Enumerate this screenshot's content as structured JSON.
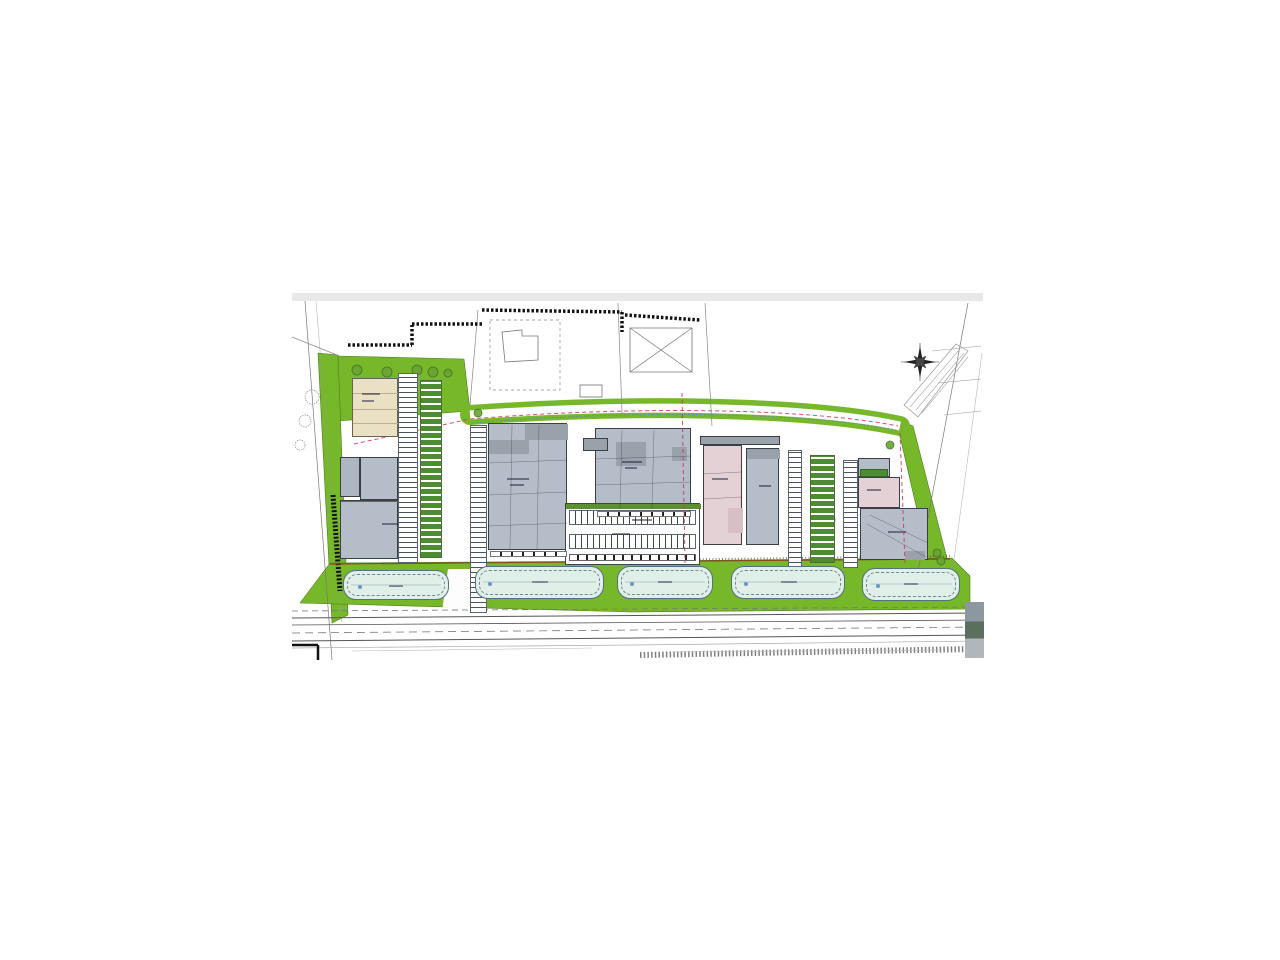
{
  "app": {
    "name": "architectural-site-plan",
    "description": "Scanned architectural site plan of a commercial development with five parking lots along a road, gray warehouse buildings, a beige block, pink blocks, green landscaping and a red location arrow marking one unit"
  },
  "palette": {
    "paper": "#ffffff",
    "topbar": "#e8e8e8",
    "green": "#76b82a",
    "green_edge": "#4e7d1e",
    "green_dark": "#4d8c33",
    "lot_fill": "#e0efe8",
    "lot_edge": "#55707e",
    "gray": "#b5bdc9",
    "gray_dark": "#99a1ab",
    "beige": "#eae1c4",
    "pink": "#e4d1d5",
    "pink_dark": "#d8bfc6",
    "terrace_green": "#5d9032",
    "marker_red": "#e81c1d",
    "red_dash": "#cc3060",
    "blue_dash": "#5b7fd4",
    "brown": "#8a4a20",
    "ink": "#333333"
  },
  "plan": {
    "x": 292,
    "y": 293,
    "w": 691,
    "h": 367,
    "topbar_h": 8
  },
  "band": {
    "d": "M178,122 C350,110 520,114 608,133",
    "green_w": 20,
    "road_w": 9,
    "red_d": "M62,151 L178,126 C350,112 520,116 606,133",
    "blue_d": "M180,130 C350,116 520,120 604,137"
  },
  "greens": [
    {
      "name": "green-topleft",
      "pts": "45,63 172,66 178,118 45,128"
    },
    {
      "name": "green-left-verge",
      "pts": "26,60 46,62 56,322 40,330"
    },
    {
      "name": "green-right-wedge",
      "pts": "604,126 621,133 658,277 640,282"
    },
    {
      "name": "green-bottom-strip",
      "pts": "8,310 38,270 350,268 660,265 678,283 678,316 340,319"
    }
  ],
  "polygons": [
    {
      "name": "access-road",
      "pts": "156,276 184,276 190,318 150,318",
      "f": "#fdfdfd"
    },
    {
      "name": "neighbor-house-outline",
      "pts": "210,39 230,37 230,43 246,43 246,67 213,69",
      "f": "none",
      "s": "#777",
      "w": 0.8
    },
    {
      "name": "neighbor-barn-outline",
      "pts": "338,35 400,35 400,79 338,79",
      "f": "none",
      "s": "#777",
      "w": 0.8
    },
    {
      "name": "parcel-dashed",
      "pts": "198,27 268,27 268,97 198,97",
      "f": "none",
      "s": "#888",
      "w": 0.7,
      "d": "3 3"
    },
    {
      "name": "label-box",
      "pts": "288,92 310,92 310,104 288,104",
      "f": "none",
      "s": "#666",
      "w": 0.7
    },
    {
      "name": "driveway-outline",
      "pts": "612,112 664,51 676,58 626,124",
      "f": "none",
      "s": "#999",
      "w": 0.7
    }
  ],
  "lines": [
    [
      13,
      8,
      40,
      367,
      "#777",
      0.7,
      0,
      0,
      "u"
    ],
    [
      24,
      8,
      50,
      330,
      "#999",
      0.6,
      0,
      0.7,
      "u"
    ],
    [
      0,
      44,
      45,
      62,
      "#888",
      0.7,
      0,
      0,
      "u"
    ],
    [
      186,
      17,
      178,
      112,
      "#888",
      0.7,
      0,
      0,
      "u"
    ],
    [
      326,
      10,
      330,
      120,
      "#888",
      0.7,
      0,
      0,
      "u"
    ],
    [
      413,
      10,
      420,
      133,
      "#888",
      0.7,
      0,
      0,
      "u"
    ],
    [
      676,
      10,
      622,
      300,
      "#777",
      0.7,
      0,
      0,
      "u"
    ],
    [
      690,
      60,
      658,
      296,
      "#999",
      0.6,
      0,
      0.7,
      "u"
    ],
    [
      640,
      58,
      689,
      53,
      "#999",
      0.6,
      0,
      0,
      "u"
    ],
    [
      646,
      90,
      689,
      86,
      "#999",
      0.6,
      0,
      0,
      "u"
    ],
    [
      652,
      122,
      689,
      118,
      "#999",
      0.6,
      0,
      0,
      "u"
    ],
    [
      338,
      35,
      400,
      79,
      "#777",
      0.7,
      0,
      0,
      "u"
    ],
    [
      400,
      35,
      338,
      79,
      "#777",
      0.7,
      0,
      0,
      "u"
    ],
    [
      56,
      52,
      120,
      52,
      "#111",
      3.5,
      "2.5 2",
      0,
      "u"
    ],
    [
      120,
      52,
      120,
      32,
      "#111",
      3.5,
      "2.5 2",
      0,
      "u"
    ],
    [
      120,
      31,
      190,
      31,
      "#111",
      3.5,
      "2.5 2",
      0,
      "u"
    ],
    [
      190,
      17,
      330,
      19,
      "#111",
      3.5,
      "2.5 2",
      0,
      "u"
    ],
    [
      330,
      19,
      330,
      39,
      "#111",
      3.5,
      "2.5 2",
      0,
      "u"
    ],
    [
      333,
      22,
      408,
      27,
      "#111",
      3.5,
      "2.5 2",
      0,
      "u"
    ],
    [
      41,
      202,
      48,
      298,
      "#111",
      5,
      "2 1.8",
      0,
      "u"
    ],
    [
      38,
      271,
      658,
      266,
      "#8a4a20",
      1.2,
      0,
      0,
      "u"
    ],
    [
      350,
      267,
      658,
      263,
      "#555",
      2,
      "1 2.2",
      0.7,
      "u"
    ],
    [
      0,
      318,
      691,
      314,
      "#777",
      0.8,
      "6 4",
      0,
      "u"
    ],
    [
      0,
      325,
      691,
      320,
      "#555",
      1,
      0,
      0,
      "u"
    ],
    [
      0,
      332,
      691,
      327,
      "#555",
      0.8,
      0,
      0,
      "u"
    ],
    [
      0,
      340,
      691,
      334,
      "#777",
      0.8,
      "8 5",
      0,
      "u"
    ],
    [
      0,
      348,
      691,
      342,
      "#555",
      1,
      0,
      0,
      "u"
    ],
    [
      0,
      355,
      340,
      352,
      "#aaa",
      0.7,
      0,
      0,
      "u"
    ],
    [
      340,
      352,
      691,
      348,
      "#aaa",
      0.7,
      0,
      0,
      "u"
    ],
    [
      348,
      362,
      683,
      356,
      "#555",
      6,
      "1.5 2.2",
      0.75,
      "u"
    ],
    [
      0,
      352,
      26,
      352,
      "#111",
      2.5,
      0,
      0,
      "u"
    ],
    [
      26,
      352,
      26,
      367,
      "#111",
      2.5,
      0,
      0,
      "u"
    ],
    [
      618,
      114,
      668,
      56,
      "#aaa",
      0.6,
      0,
      0,
      "u"
    ],
    [
      624,
      117,
      672,
      60,
      "#aaa",
      0.6,
      0,
      0,
      "u"
    ],
    [
      630,
      120,
      676,
      64,
      "#aaa",
      0.6,
      0,
      0,
      "u"
    ],
    [
      60,
      358,
      300,
      355,
      "#bbb",
      0.6,
      0,
      0,
      "u"
    ],
    [
      380,
      359,
      650,
      357,
      "#bbb",
      0.6,
      0,
      0,
      "u"
    ],
    [
      628,
      50,
      628,
      88,
      "#333",
      0.6,
      0,
      0,
      "u"
    ],
    [
      609,
      69,
      647,
      69,
      "#333",
      0.6,
      0,
      0,
      "u"
    ],
    [
      220,
      132,
      218,
      256,
      "#223",
      0.5,
      0,
      0.5,
      "o"
    ],
    [
      247,
      132,
      245,
      256,
      "#223",
      0.5,
      0,
      0.5,
      "o"
    ],
    [
      196,
      170,
      275,
      167,
      "#223",
      0.5,
      0,
      0.5,
      "o"
    ],
    [
      196,
      202,
      275,
      199,
      "#223",
      0.5,
      0,
      0.5,
      "o"
    ],
    [
      196,
      233,
      275,
      230,
      "#223",
      0.5,
      0,
      0.5,
      "o"
    ],
    [
      330,
      137,
      328,
      216,
      "#223",
      0.5,
      0,
      0.5,
      "o"
    ],
    [
      362,
      137,
      360,
      216,
      "#223",
      0.5,
      0,
      0.5,
      "o"
    ],
    [
      303,
      166,
      399,
      163,
      "#223",
      0.5,
      0,
      0.5,
      "o"
    ],
    [
      303,
      192,
      399,
      189,
      "#223",
      0.5,
      0,
      0.5,
      "o"
    ],
    [
      575,
      231,
      634,
      264,
      "#223",
      0.5,
      0,
      0.5,
      "o"
    ],
    [
      578,
      222,
      636,
      250,
      "#223",
      0.5,
      0,
      0.5,
      "o"
    ],
    [
      411,
      181,
      449,
      179,
      "#223",
      0.5,
      0,
      0.5,
      "o"
    ],
    [
      411,
      206,
      449,
      204,
      "#223",
      0.5,
      0,
      0.5,
      "o"
    ],
    [
      59,
      292,
      149,
      292,
      "#88a0aa",
      0.5,
      0,
      0,
      "o"
    ],
    [
      191,
      289,
      304,
      289,
      "#88a0aa",
      0.5,
      0,
      0,
      "o"
    ],
    [
      333,
      289,
      413,
      289,
      "#88a0aa",
      0.5,
      0,
      0,
      "o"
    ],
    [
      447,
      289,
      545,
      289,
      "#88a0aa",
      0.5,
      0,
      0,
      "o"
    ],
    [
      578,
      291,
      660,
      291,
      "#88a0aa",
      0.5,
      0,
      0,
      "o"
    ],
    [
      390,
      100,
      393,
      270,
      "#cc3060",
      1,
      "4 3",
      0.85,
      "o"
    ],
    [
      608,
      140,
      613,
      270,
      "#cc3060",
      1,
      "4 3",
      0.85,
      "o"
    ]
  ],
  "buildings": [
    {
      "name": "building-beige",
      "x": 60,
      "y": 85,
      "w": 46,
      "h": 59,
      "f": "#eae1c4",
      "b": "#6b6350",
      "subs": [
        [
          0,
          14,
          46,
          1,
          "#b9b092"
        ],
        [
          0,
          30,
          46,
          1,
          "#b9b092"
        ],
        [
          0,
          44,
          46,
          1,
          "#b9b092"
        ]
      ]
    },
    {
      "name": "building-gray-small",
      "x": 48,
      "y": 164,
      "w": 20,
      "h": 40,
      "f": "#aeb6c2",
      "b": "#3a3f46",
      "subs": []
    },
    {
      "name": "building-gray-upper",
      "x": 68,
      "y": 164,
      "w": 38,
      "h": 43,
      "f": "#b5bdc9",
      "b": "#3a3f46",
      "subs": []
    },
    {
      "name": "building-gray-main-left",
      "x": 48,
      "y": 207,
      "w": 58,
      "h": 59,
      "f": "#b5bdc9",
      "b": "#3a3f46",
      "subs": [
        [
          0,
          0,
          58,
          1,
          "#666"
        ]
      ]
    },
    {
      "name": "warehouse-1",
      "x": 196,
      "y": 130,
      "w": 79,
      "h": 127,
      "f": "#b5bdc9",
      "b": "#3a3f46",
      "subs": [
        [
          36,
          0,
          43,
          16,
          "#99a1ab"
        ],
        [
          0,
          16,
          40,
          14,
          "#99a1ab"
        ]
      ]
    },
    {
      "name": "warehouse-2",
      "x": 303,
      "y": 135,
      "w": 96,
      "h": 82,
      "f": "#b5bdc9",
      "b": "#3a3f46",
      "subs": [
        [
          20,
          13,
          30,
          24,
          "#99a1ab"
        ],
        [
          76,
          18,
          15,
          14,
          "#99a1ab"
        ]
      ]
    },
    {
      "name": "dark-infill-block",
      "x": 291,
      "y": 145,
      "w": 25,
      "h": 13,
      "f": "#99a1ab",
      "b": "#3a3f46",
      "subs": []
    },
    {
      "name": "terrace-block",
      "x": 273,
      "y": 210,
      "w": 135,
      "h": 62,
      "f": "#fefefe",
      "b": "#444",
      "subs": [
        [
          0,
          0,
          135,
          5,
          "#5d9032"
        ]
      ]
    },
    {
      "name": "roof-strip-dark",
      "x": 408,
      "y": 143,
      "w": 80,
      "h": 9,
      "f": "#9aa2ac",
      "b": "#3a3f46",
      "subs": []
    },
    {
      "name": "building-pink",
      "x": 411,
      "y": 152,
      "w": 39,
      "h": 100,
      "f": "#e4d1d5",
      "b": "#3a3f46",
      "subs": [
        [
          24,
          62,
          15,
          25,
          "#d8bfc6"
        ]
      ]
    },
    {
      "name": "building-gray-mid-right",
      "x": 454,
      "y": 155,
      "w": 33,
      "h": 97,
      "f": "#b5bdc9",
      "b": "#3a3f46",
      "subs": [
        [
          0,
          0,
          33,
          10,
          "#99a1ab"
        ]
      ]
    },
    {
      "name": "right-gray-strip",
      "x": 566,
      "y": 165,
      "w": 32,
      "h": 19,
      "f": "#b5bdc9",
      "b": "#3a3f46",
      "subs": []
    },
    {
      "name": "green-bays-row",
      "x": 568,
      "y": 176,
      "w": 28,
      "h": 8,
      "f": "#4d8c33",
      "b": "#2f6622",
      "subs": []
    },
    {
      "name": "building-pink-right",
      "x": 566,
      "y": 184,
      "w": 42,
      "h": 31,
      "f": "#e4d1d5",
      "b": "#3a3f46",
      "subs": []
    },
    {
      "name": "building-gray-right-marked",
      "x": 568,
      "y": 215,
      "w": 68,
      "h": 52,
      "f": "#b5bdc9",
      "b": "#3a3f46",
      "subs": [
        [
          44,
          42,
          20,
          9,
          "#99a1ab"
        ]
      ]
    }
  ],
  "strips": [
    {
      "name": "parking-col-left-1",
      "x": 106,
      "y": 80,
      "w": 20,
      "h": 190,
      "ang": 0,
      "a": "#fdfdfd",
      "aw": 4,
      "b": "#4a545e",
      "bw": 1,
      "br": "#5a6470"
    },
    {
      "name": "green-bays-left-court",
      "x": 128,
      "y": 87,
      "w": 22,
      "h": 178,
      "ang": 0,
      "a": "#4d8c33",
      "aw": 5,
      "b": "#ffffff",
      "bw": 2,
      "br": "#4a6f35"
    },
    {
      "name": "parking-col-left-2",
      "x": 178,
      "y": 132,
      "w": 17,
      "h": 188,
      "ang": 0,
      "a": "#fdfdfd",
      "aw": 4,
      "b": "#4a545e",
      "bw": 1,
      "br": "#5a6470"
    },
    {
      "name": "parking-col-right-1",
      "x": 496,
      "y": 157,
      "w": 14,
      "h": 118,
      "ang": 0,
      "a": "#fdfdfd",
      "aw": 4,
      "b": "#4a545e",
      "bw": 1,
      "br": "#5a6470"
    },
    {
      "name": "green-bays-right-court",
      "x": 518,
      "y": 162,
      "w": 25,
      "h": 108,
      "ang": 0,
      "a": "#4d8c33",
      "aw": 5,
      "b": "#ffffff",
      "bw": 2,
      "br": "#4a6f35"
    },
    {
      "name": "parking-col-right-2",
      "x": 551,
      "y": 167,
      "w": 15,
      "h": 108,
      "ang": 0,
      "a": "#fdfdfd",
      "aw": 4,
      "b": "#4a545e",
      "bw": 1,
      "br": "#5a6470"
    },
    {
      "name": "terrace-bays-row-1",
      "x": 277,
      "y": 217,
      "w": 127,
      "h": 15,
      "ang": 90,
      "a": "#fdfdfd",
      "aw": 5,
      "b": "#3f4a3f",
      "bw": 1,
      "br": "#5a6470"
    },
    {
      "name": "terrace-bays-row-2",
      "x": 277,
      "y": 241,
      "w": 127,
      "h": 15,
      "ang": 90,
      "a": "#fdfdfd",
      "aw": 5,
      "b": "#3f4a3f",
      "bw": 1,
      "br": "#5a6470"
    },
    {
      "name": "terrace-doors-row",
      "x": 277,
      "y": 261,
      "w": 127,
      "h": 7,
      "ang": 90,
      "a": "#fdfdfd",
      "aw": 7,
      "b": "#222222",
      "bw": 2,
      "br": "#666"
    },
    {
      "name": "warehouse-1-doors",
      "x": 198,
      "y": 258,
      "w": 77,
      "h": 6,
      "ang": 90,
      "a": "#ffffff",
      "aw": 9,
      "b": "#222222",
      "bw": 2,
      "br": "#777"
    },
    {
      "name": "warehouse-2-doors",
      "x": 305,
      "y": 218,
      "w": 94,
      "h": 6,
      "ang": 90,
      "a": "#ffffff",
      "aw": 9,
      "b": "#222222",
      "bw": 2,
      "br": "#777"
    }
  ],
  "lots": [
    {
      "name": "parking-lot-1",
      "x": 51,
      "y": 277,
      "w": 106,
      "h": 30
    },
    {
      "name": "parking-lot-2",
      "x": 183,
      "y": 273,
      "w": 129,
      "h": 33
    },
    {
      "name": "parking-lot-3",
      "x": 325,
      "y": 273,
      "w": 96,
      "h": 33
    },
    {
      "name": "parking-lot-4",
      "x": 439,
      "y": 273,
      "w": 114,
      "h": 33
    },
    {
      "name": "parking-lot-5",
      "x": 570,
      "y": 275,
      "w": 98,
      "h": 33
    }
  ],
  "lot_dots": [
    [
      66,
      292
    ],
    [
      196,
      289
    ],
    [
      338,
      289
    ],
    [
      452,
      289
    ],
    [
      584,
      291
    ]
  ],
  "trees_green": [
    [
      65,
      77,
      5
    ],
    [
      95,
      79,
      5
    ],
    [
      125,
      77,
      5
    ],
    [
      141,
      79,
      5
    ],
    [
      156,
      80,
      4
    ],
    [
      186,
      120,
      4
    ],
    [
      136,
      177,
      6
    ],
    [
      136,
      207,
      6
    ],
    [
      141,
      237,
      5
    ],
    [
      526,
      172,
      6
    ],
    [
      534,
      189,
      6
    ],
    [
      538,
      227,
      5
    ],
    [
      645,
      260,
      4
    ],
    [
      649,
      268,
      4
    ],
    [
      598,
      152,
      4
    ]
  ],
  "trees_gray": [
    [
      20,
      104,
      7
    ],
    [
      13,
      128,
      6
    ],
    [
      8,
      152,
      5
    ]
  ],
  "smudges": [
    [
      70,
      100,
      18
    ],
    [
      70,
      107,
      12
    ],
    [
      215,
      185,
      22
    ],
    [
      218,
      191,
      14
    ],
    [
      330,
      168,
      20
    ],
    [
      333,
      174,
      12
    ],
    [
      420,
      185,
      16
    ],
    [
      467,
      192,
      12
    ],
    [
      596,
      238,
      18
    ],
    [
      575,
      196,
      14
    ],
    [
      90,
      230,
      16
    ],
    [
      320,
      240,
      18
    ],
    [
      340,
      226,
      20
    ],
    [
      97,
      292,
      14
    ],
    [
      240,
      288,
      16
    ],
    [
      366,
      288,
      14
    ],
    [
      489,
      288,
      16
    ],
    [
      612,
      290,
      14
    ]
  ],
  "glyphs": [
    {
      "x": 281,
      "y": 95,
      "t": "◄",
      "s": 7,
      "c": "#333",
      "name": "pointer-left-icon"
    },
    {
      "x": 390,
      "y": 96,
      "t": "◄",
      "s": 7,
      "c": "#333",
      "name": "pointer-left-icon"
    },
    {
      "x": 253,
      "y": 285,
      "t": "◄",
      "s": 6,
      "c": "#445",
      "name": "pointer-left-icon"
    },
    {
      "x": 8,
      "y": 194,
      "t": "▲",
      "s": 6,
      "c": "#111",
      "name": "survey-triangle-icon"
    },
    {
      "x": 658,
      "y": 192,
      "t": "▲",
      "s": 6,
      "c": "#111",
      "name": "survey-triangle-icon"
    },
    {
      "x": 102,
      "y": 258,
      "t": "▲",
      "s": 5,
      "c": "#111",
      "name": "survey-triangle-icon"
    },
    {
      "x": 298,
      "y": 258,
      "t": "▲",
      "s": 5,
      "c": "#111",
      "name": "survey-triangle-icon"
    }
  ],
  "compass": {
    "cx": 628,
    "cy": 69,
    "r_long": 16,
    "r_short": 9,
    "r_inner": 3.5
  },
  "arrow": {
    "pts": "617,226 629,226 629,241 636,241 623,257 610,241 617,241",
    "f": "#e81c1d",
    "s": "#8e0f10"
  },
  "photo": {
    "x": 673,
    "y": 309,
    "w": 19,
    "h": 56,
    "c1": "#8b98a0",
    "c2": "#5c6e5e",
    "c3": "#b0b6ba"
  }
}
